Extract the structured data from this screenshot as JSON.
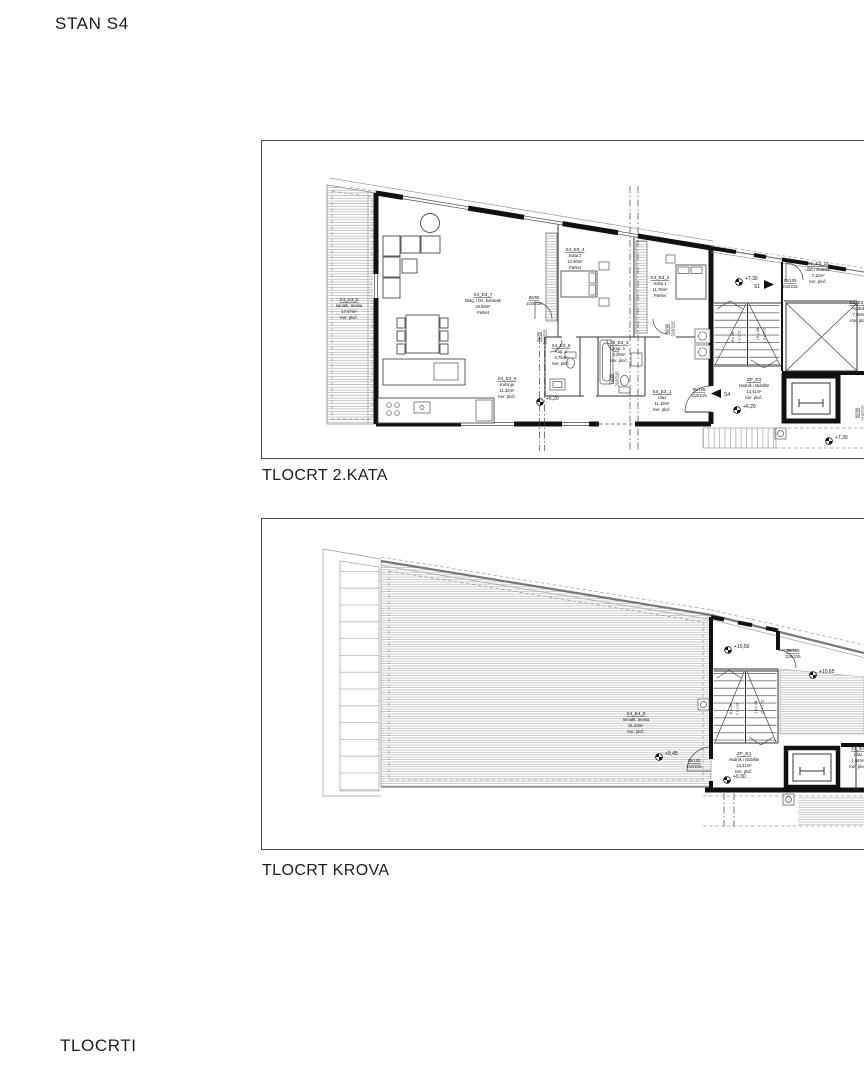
{
  "page": {
    "title": "STAN S4",
    "footer": "TLOCRTI"
  },
  "plan_floor": {
    "caption": "TLOCRT 2.KATA",
    "rooms": {
      "terrace": {
        "id": "S4_E3_8",
        "name": "nenatk. terasa",
        "area": "17,57m²",
        "finish": "Ker. ploč."
      },
      "living": {
        "id": "S4_E3_7",
        "name": "Blag. i Dn. boravak",
        "area": "34,86m²",
        "finish": "Parket"
      },
      "kitchen": {
        "id": "S4_E3_6",
        "name": "Kuhinja",
        "area": "11,32m²",
        "finish": "Ker. ploč."
      },
      "bath2": {
        "id": "S4_E3_5",
        "name": "Kup. 2",
        "area": "3,75m²",
        "finish": "Ker. ploč."
      },
      "bedroom2": {
        "id": "S4_E3_4",
        "name": "Soba 2",
        "area": "12,90m²",
        "finish": "Parket"
      },
      "bath1": {
        "id": "S4_E3_3",
        "name": "Kup. 1",
        "area": "4,29m²",
        "finish": "Ker. ploč."
      },
      "bedroom1": {
        "id": "S4_E3_2",
        "name": "Soba 1",
        "area": "11,76m²",
        "finish": "Parket"
      },
      "entry": {
        "id": "S4_E3_1",
        "name": "Ulaz",
        "area": "11,18m²",
        "finish": "Ker. ploč."
      },
      "core": {
        "id": "ZP_E3",
        "name": "Hodnik i stubište",
        "area": "13,41m²",
        "finish": "Ker. ploč."
      },
      "s1_entry": {
        "id": "S1_E3_14",
        "name": "ulaz i stubište",
        "area": "7,12m²",
        "finish": "Ker. ploč."
      },
      "s1_hall": {
        "id": "S1_E3_1",
        "name": "Hodnik",
        "area": "7,36m²",
        "finish": "Ker. ploč."
      }
    },
    "doors": [
      {
        "size": "80/90",
        "height": "210/215"
      },
      {
        "size": "75/85",
        "height": "210/215"
      },
      {
        "size": "70/80",
        "height": "210/215"
      },
      {
        "size": "80/90",
        "height": "210/215"
      },
      {
        "size": "95/105",
        "height": "210/215"
      },
      {
        "size": "95/105",
        "height": "210/215"
      },
      {
        "size": "80/90",
        "height": "210/215"
      }
    ],
    "levels": [
      "+7,30",
      "+6,20",
      "+6,20",
      "+7,30"
    ],
    "stairs": [
      "8 x 28",
      "7 x 172",
      "10 x 28",
      "9 x 172"
    ],
    "unit_arrows": {
      "s4": "S4",
      "s1": "S1"
    }
  },
  "plan_roof": {
    "caption": "TLOCRT KROVA",
    "rooms": {
      "roof_terrace": {
        "id": "S4_E4_9",
        "name": "nenatk. terasa",
        "area": "61,33m²",
        "finish": "Ker. ploč."
      },
      "core": {
        "id": "ZP_E4",
        "name": "Hodnik i stubište",
        "area": "13,41m²",
        "finish": "Ker. ploč."
      },
      "s1_entry": {
        "id": "S1_E4",
        "name": "Ulaz",
        "area": "1,64m²",
        "finish": "Ker. ploč."
      }
    },
    "doors": [
      {
        "size": "95/105",
        "height": "210/215"
      },
      {
        "size": "95/105",
        "height": "210/215"
      }
    ],
    "levels": [
      "+10,50",
      "+10,65",
      "+9,45",
      "+9,30"
    ],
    "stairs": [
      "8 x 28",
      "7 x 172",
      "10 x 28",
      "11 x 172"
    ]
  }
}
